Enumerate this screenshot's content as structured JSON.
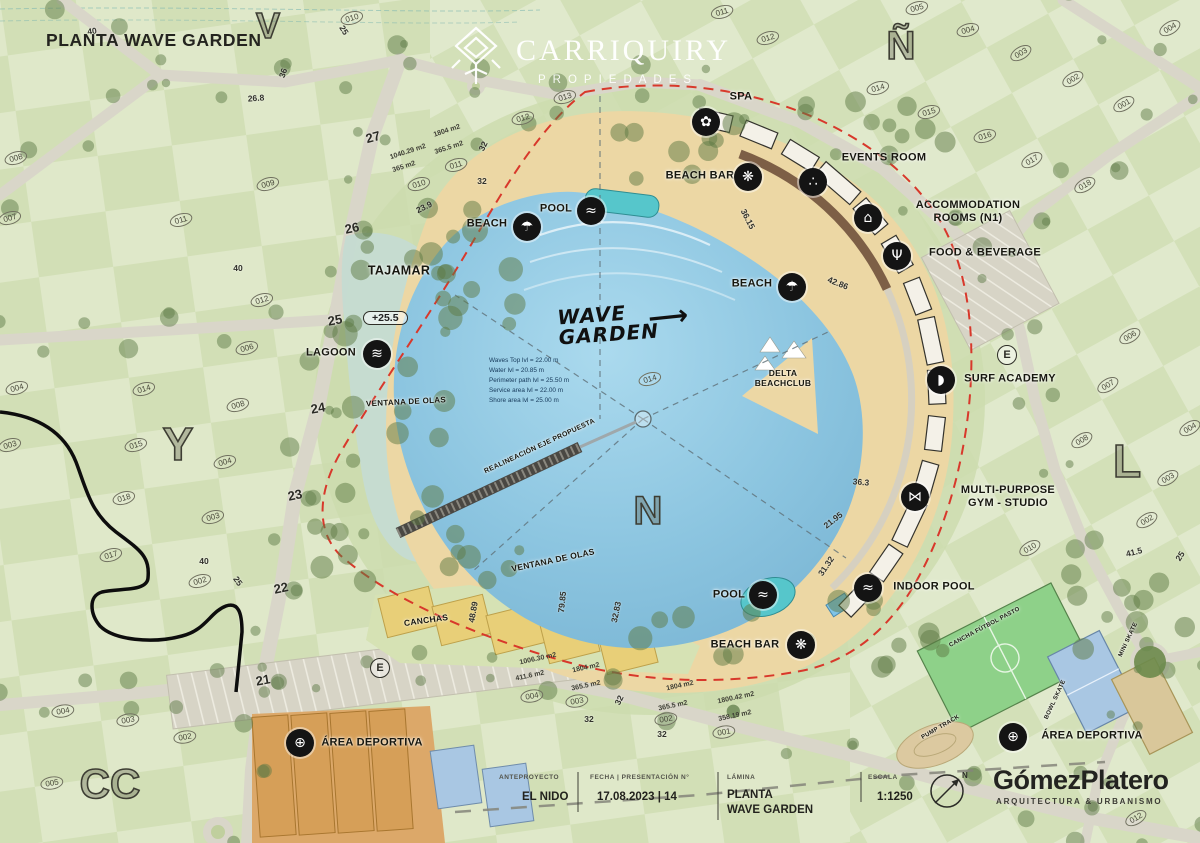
{
  "header": {
    "title": "PLANTA WAVE GARDEN"
  },
  "logo": {
    "name": "CARRIQUIRY",
    "sub": "PROPIEDADES"
  },
  "colors": {
    "sand": "#ecd7a4",
    "red_boundary": "#d8382b",
    "road": "#d9d6c9",
    "water_main": "#8cc5e0",
    "tajamar_water": "#c5dbd2",
    "courts_orange": "#dca869",
    "courts_yellow": "#e8cf78",
    "field_green": "#8ed189",
    "court_blue": "#a9c7e3",
    "icon_bg": "#141414"
  },
  "facilities": [
    {
      "label": "SPA",
      "x": 741,
      "y": 97,
      "ix": 706,
      "iy": 122,
      "icon": "spa-icon",
      "g": "✿"
    },
    {
      "label": "EVENTS ROOM",
      "x": 884,
      "y": 158,
      "ix": 813,
      "iy": 182,
      "icon": "events-room-icon",
      "g": "∴"
    },
    {
      "label": "BEACH BAR",
      "x": 700,
      "y": 176,
      "ix": 748,
      "iy": 177,
      "icon": "beach-bar-icon",
      "g": "❋"
    },
    {
      "label": "ACCOMMODATION\nROOMS (N1)",
      "x": 968,
      "y": 212,
      "ix": 868,
      "iy": 218,
      "icon": "accommodation-icon",
      "g": "⌂"
    },
    {
      "label": "FOOD & BEVERAGE",
      "x": 985,
      "y": 253,
      "ix": 897,
      "iy": 256,
      "icon": "food-beverage-icon",
      "g": "Ψ"
    },
    {
      "label": "BEACH",
      "x": 487,
      "y": 224,
      "ix": 527,
      "iy": 227,
      "icon": "beach-umbrella-icon",
      "g": "☂"
    },
    {
      "label": "POOL",
      "x": 556,
      "y": 209,
      "ix": 591,
      "iy": 211,
      "icon": "pool-ladder-icon",
      "g": "≈"
    },
    {
      "label": "BEACH",
      "x": 752,
      "y": 284,
      "ix": 792,
      "iy": 287,
      "icon": "beach-umbrella-icon",
      "g": "☂"
    },
    {
      "label": "SURF ACADEMY",
      "x": 1010,
      "y": 379,
      "ix": 941,
      "iy": 380,
      "icon": "surf-academy-icon",
      "g": "◗"
    },
    {
      "label": "MULTI-PURPOSE\nGYM - STUDIO",
      "x": 1008,
      "y": 497,
      "ix": 915,
      "iy": 497,
      "icon": "gym-icon",
      "g": "⋈"
    },
    {
      "label": "INDOOR POOL",
      "x": 934,
      "y": 587,
      "ix": 868,
      "iy": 588,
      "icon": "indoor-pool-icon",
      "g": "≈"
    },
    {
      "label": "POOL",
      "x": 729,
      "y": 595,
      "ix": 763,
      "iy": 595,
      "icon": "pool-ladder-icon",
      "g": "≈"
    },
    {
      "label": "BEACH BAR",
      "x": 745,
      "y": 645,
      "ix": 801,
      "iy": 645,
      "icon": "beach-bar-icon",
      "g": "❋"
    },
    {
      "label": "LAGOON",
      "x": 331,
      "y": 353,
      "ix": 377,
      "iy": 354,
      "icon": "lagoon-icon",
      "g": "≋"
    },
    {
      "label": "ÁREA DEPORTIVA",
      "x": 372,
      "y": 743,
      "ix": 300,
      "iy": 743,
      "icon": "sports-ball-icon",
      "g": "⊕"
    },
    {
      "label": "ÁREA DEPORTIVA",
      "x": 1092,
      "y": 736,
      "ix": 1013,
      "iy": 737,
      "icon": "sports-ball-icon",
      "g": "⊕"
    }
  ],
  "labels": [
    {
      "t": "TAJAMAR",
      "x": 399,
      "y": 271,
      "fs": 12.5,
      "rot": 0
    },
    {
      "t": "DELTA\nBEACHCLUB",
      "x": 783,
      "y": 378,
      "fs": 8.5,
      "rot": 0
    },
    {
      "t": "CANCHAS",
      "x": 426,
      "y": 620,
      "fs": 8.5,
      "rot": -8
    },
    {
      "t": "VENTANA DE OLAS",
      "x": 406,
      "y": 402,
      "fs": 8,
      "rot": -3
    },
    {
      "t": "VENTANA DE OLAS",
      "x": 553,
      "y": 560,
      "fs": 8.5,
      "rot": -12
    },
    {
      "t": "REALINEACIÓN EJE PROPUESTA",
      "x": 540,
      "y": 447,
      "fs": 7,
      "rot": -25
    },
    {
      "t": "CANCHA FÚTBOL PASTO",
      "x": 985,
      "y": 628,
      "fs": 6,
      "rot": -28
    },
    {
      "t": "BOWL SKATE",
      "x": 1056,
      "y": 700,
      "fs": 6,
      "rot": -65
    },
    {
      "t": "PUMP TRACK",
      "x": 941,
      "y": 728,
      "fs": 6,
      "rot": -30
    },
    {
      "t": "MINI SKATE",
      "x": 1129,
      "y": 640,
      "fs": 6,
      "rot": -65
    }
  ],
  "measurements": [
    {
      "t": "36.15",
      "x": 748,
      "y": 219,
      "rot": 63
    },
    {
      "t": "42.86",
      "x": 838,
      "y": 283,
      "rot": 22
    },
    {
      "t": "36.3",
      "x": 861,
      "y": 482,
      "rot": 5
    },
    {
      "t": "21.95",
      "x": 833,
      "y": 520,
      "rot": -38
    },
    {
      "t": "31.32",
      "x": 826,
      "y": 566,
      "rot": -56
    },
    {
      "t": "32.83",
      "x": 616,
      "y": 612,
      "rot": -78
    },
    {
      "t": "79.85",
      "x": 562,
      "y": 602,
      "rot": -84
    },
    {
      "t": "48.89",
      "x": 473,
      "y": 612,
      "rot": -80
    },
    {
      "t": "23.9",
      "x": 424,
      "y": 207,
      "rot": -26
    },
    {
      "t": "26.8",
      "x": 256,
      "y": 98,
      "rot": -4
    },
    {
      "t": "40",
      "x": 92,
      "y": 31,
      "rot": -8
    },
    {
      "t": "40",
      "x": 238,
      "y": 268,
      "rot": 0
    },
    {
      "t": "40",
      "x": 204,
      "y": 561,
      "rot": 0
    },
    {
      "t": "25",
      "x": 344,
      "y": 30,
      "rot": 58
    },
    {
      "t": "25",
      "x": 238,
      "y": 581,
      "rot": 55
    },
    {
      "t": "25",
      "x": 1180,
      "y": 556,
      "rot": -58
    },
    {
      "t": "41.5",
      "x": 1134,
      "y": 552,
      "rot": -14
    },
    {
      "t": "32",
      "x": 483,
      "y": 146,
      "rot": -64
    },
    {
      "t": "32",
      "x": 482,
      "y": 181,
      "rot": 0
    },
    {
      "t": "32",
      "x": 619,
      "y": 700,
      "rot": -64
    },
    {
      "t": "32",
      "x": 589,
      "y": 719,
      "rot": 0
    },
    {
      "t": "32",
      "x": 662,
      "y": 734,
      "rot": 0
    },
    {
      "t": "36",
      "x": 283,
      "y": 73,
      "rot": -72
    }
  ],
  "areas_m2": [
    {
      "t": "1040.29 m2",
      "x": 408,
      "y": 152,
      "rot": -18
    },
    {
      "t": "365 m2",
      "x": 404,
      "y": 167,
      "rot": -18
    },
    {
      "t": "1804 m2",
      "x": 447,
      "y": 131,
      "rot": -18
    },
    {
      "t": "365.5 m2",
      "x": 449,
      "y": 148,
      "rot": -18
    },
    {
      "t": "1006.30 m2",
      "x": 538,
      "y": 659,
      "rot": -12
    },
    {
      "t": "411.6 m2",
      "x": 530,
      "y": 676,
      "rot": -12
    },
    {
      "t": "1804 m2",
      "x": 586,
      "y": 668,
      "rot": -12
    },
    {
      "t": "365.5 m2",
      "x": 586,
      "y": 686,
      "rot": -12
    },
    {
      "t": "1804 m2",
      "x": 680,
      "y": 686,
      "rot": -12
    },
    {
      "t": "365.5 m2",
      "x": 673,
      "y": 706,
      "rot": -12
    },
    {
      "t": "1800.42 m2",
      "x": 736,
      "y": 698,
      "rot": -12
    },
    {
      "t": "358.19 m2",
      "x": 735,
      "y": 716,
      "rot": -12
    }
  ],
  "lots": [
    {
      "t": "008",
      "x": 16,
      "y": 158
    },
    {
      "t": "007",
      "x": 10,
      "y": 218
    },
    {
      "t": "011",
      "x": 181,
      "y": 220
    },
    {
      "t": "009",
      "x": 268,
      "y": 184
    },
    {
      "t": "012",
      "x": 262,
      "y": 300
    },
    {
      "t": "006",
      "x": 247,
      "y": 348
    },
    {
      "t": "010",
      "x": 352,
      "y": 18
    },
    {
      "t": "010",
      "x": 419,
      "y": 184
    },
    {
      "t": "011",
      "x": 456,
      "y": 165
    },
    {
      "t": "013",
      "x": 565,
      "y": 97
    },
    {
      "t": "012",
      "x": 523,
      "y": 118
    },
    {
      "t": "011",
      "x": 722,
      "y": 12
    },
    {
      "t": "012",
      "x": 768,
      "y": 38
    },
    {
      "t": "005",
      "x": 917,
      "y": 8
    },
    {
      "t": "004",
      "x": 968,
      "y": 30
    },
    {
      "t": "003",
      "x": 1021,
      "y": 53
    },
    {
      "t": "002",
      "x": 1073,
      "y": 79
    },
    {
      "t": "001",
      "x": 1124,
      "y": 104
    },
    {
      "t": "014",
      "x": 878,
      "y": 88
    },
    {
      "t": "015",
      "x": 929,
      "y": 112
    },
    {
      "t": "016",
      "x": 985,
      "y": 136
    },
    {
      "t": "017",
      "x": 1032,
      "y": 160
    },
    {
      "t": "018",
      "x": 1085,
      "y": 185
    },
    {
      "t": "004",
      "x": 1170,
      "y": 28
    },
    {
      "t": "006",
      "x": 1130,
      "y": 336
    },
    {
      "t": "007",
      "x": 1108,
      "y": 385
    },
    {
      "t": "008",
      "x": 1082,
      "y": 440
    },
    {
      "t": "004",
      "x": 1190,
      "y": 428
    },
    {
      "t": "003",
      "x": 1168,
      "y": 478
    },
    {
      "t": "002",
      "x": 1147,
      "y": 520
    },
    {
      "t": "010",
      "x": 1030,
      "y": 548
    },
    {
      "t": "004",
      "x": 17,
      "y": 388
    },
    {
      "t": "014",
      "x": 144,
      "y": 389
    },
    {
      "t": "003",
      "x": 10,
      "y": 445
    },
    {
      "t": "015",
      "x": 136,
      "y": 445
    },
    {
      "t": "008",
      "x": 238,
      "y": 405
    },
    {
      "t": "004",
      "x": 225,
      "y": 462
    },
    {
      "t": "018",
      "x": 124,
      "y": 498
    },
    {
      "t": "003",
      "x": 213,
      "y": 517
    },
    {
      "t": "017",
      "x": 111,
      "y": 555
    },
    {
      "t": "002",
      "x": 200,
      "y": 581
    },
    {
      "t": "004",
      "x": 63,
      "y": 711
    },
    {
      "t": "003",
      "x": 128,
      "y": 720
    },
    {
      "t": "002",
      "x": 185,
      "y": 737
    },
    {
      "t": "005",
      "x": 52,
      "y": 783
    },
    {
      "t": "004",
      "x": 532,
      "y": 696
    },
    {
      "t": "003",
      "x": 577,
      "y": 701
    },
    {
      "t": "002",
      "x": 666,
      "y": 719
    },
    {
      "t": "001",
      "x": 724,
      "y": 732
    },
    {
      "t": "014",
      "x": 650,
      "y": 379
    },
    {
      "t": "012",
      "x": 1136,
      "y": 818
    }
  ],
  "streets": [
    {
      "t": "27",
      "x": 373,
      "y": 137,
      "rot": -15
    },
    {
      "t": "26",
      "x": 352,
      "y": 228,
      "rot": -12
    },
    {
      "t": "25",
      "x": 335,
      "y": 320,
      "rot": -10
    },
    {
      "t": "24",
      "x": 318,
      "y": 408,
      "rot": -10
    },
    {
      "t": "23",
      "x": 295,
      "y": 495,
      "rot": -12
    },
    {
      "t": "22",
      "x": 281,
      "y": 588,
      "rot": -12
    },
    {
      "t": "21",
      "x": 263,
      "y": 680,
      "rot": -10
    }
  ],
  "letters": [
    {
      "t": "V",
      "x": 268,
      "y": 26,
      "fs": 36
    },
    {
      "t": "Ñ",
      "x": 901,
      "y": 46,
      "fs": 40
    },
    {
      "t": "Y",
      "x": 178,
      "y": 444,
      "fs": 46
    },
    {
      "t": "L",
      "x": 1127,
      "y": 461,
      "fs": 46
    },
    {
      "t": "N",
      "x": 648,
      "y": 511,
      "fs": 40
    },
    {
      "t": "CC",
      "x": 110,
      "y": 784,
      "fs": 42
    }
  ],
  "circled_e": [
    {
      "t": "E",
      "x": 1007,
      "y": 355
    },
    {
      "t": "E",
      "x": 380,
      "y": 668
    }
  ],
  "annotations": {
    "wave_garden": "WAVE\nGARDEN",
    "arrow": "⟶",
    "elevation": "+25.5",
    "lagoon_stats": [
      "Waves Top lvl = 22.00 m",
      "Water lvl = 20.85 m",
      "Perimeter path lvl = 25.50 m",
      "Service area lvl = 22.00 m",
      "Shore area lvl = 25.00 m"
    ]
  },
  "titleblock": {
    "fields": [
      {
        "label": "ANTEPROYECTO",
        "value": "EL NIDO"
      },
      {
        "label": "FECHA | PRESENTACIÓN N°",
        "value": "17.08.2023 | 14"
      },
      {
        "label": "LÁMINA",
        "value": "PLANTA\nWAVE GARDEN"
      },
      {
        "label": "ESCALA",
        "value": "1:1250"
      }
    ],
    "north": "N",
    "firm": {
      "name": "GómezPlatero",
      "tagline": "ARQUITECTURA & URBANISMO"
    }
  }
}
